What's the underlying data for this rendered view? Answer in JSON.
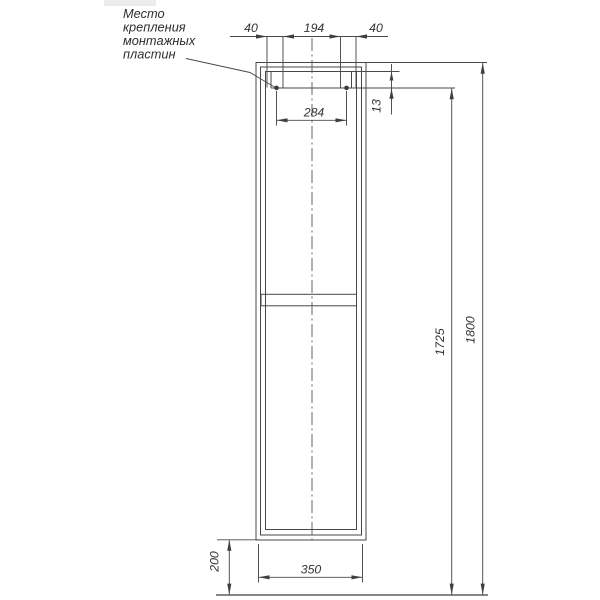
{
  "drawing": {
    "title_annotation": {
      "full_text": "Место крепления монтажных пластин",
      "lines": [
        "Место",
        "крепления",
        "монтажных",
        "пластин"
      ]
    },
    "dimensions": {
      "top_left": "40",
      "top_center": "194",
      "top_right": "40",
      "mount_span": "284",
      "mount_offset": "13",
      "height_to_mount": "1725",
      "height_total": "1800",
      "width": "350",
      "base_height": "200"
    },
    "colors": {
      "line": "#474747",
      "text": "#333333",
      "background": "#ffffff"
    }
  }
}
